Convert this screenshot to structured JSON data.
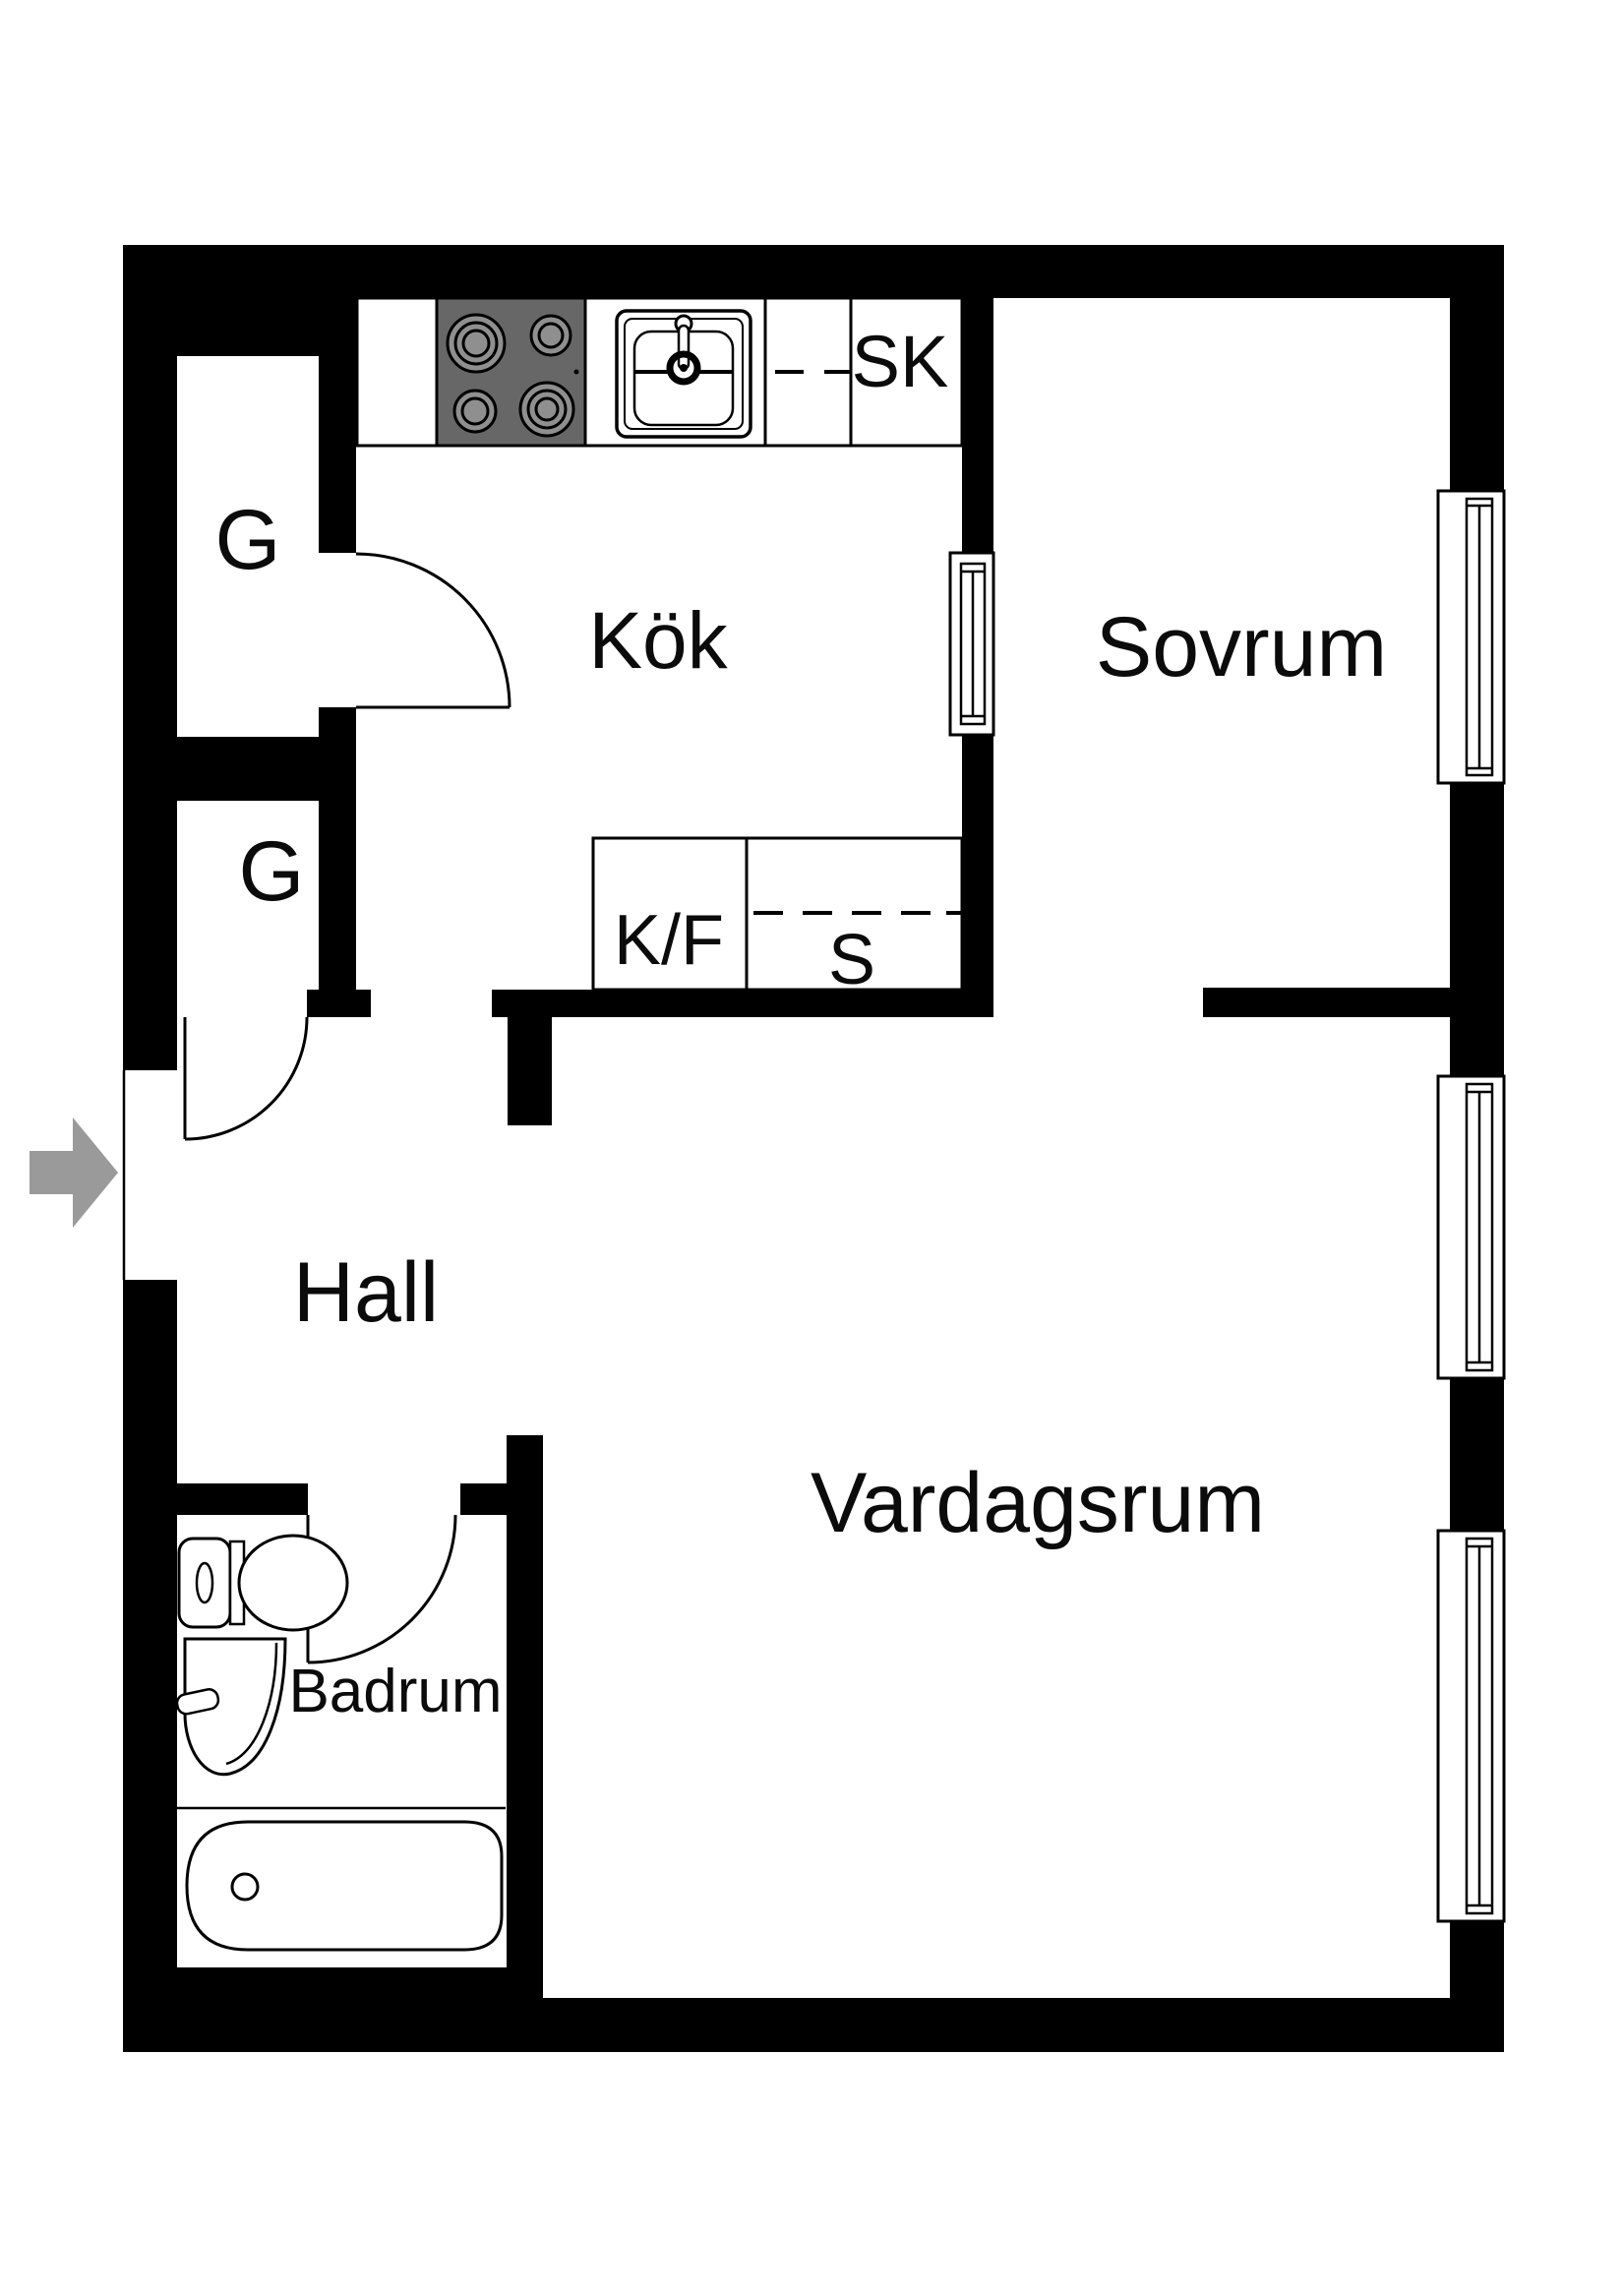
{
  "document": {
    "type": "apartment floor plan",
    "language": "Swedish"
  },
  "colors": {
    "paper": "#ffffff",
    "wall": "#000000",
    "line": "#000000",
    "stove_cell": "#676767",
    "burner": "#8f8f8f",
    "arrow": "#9a9a9a"
  },
  "labels": {
    "kitchen": "Kök",
    "bedroom": "Sovrum",
    "hall": "Hall",
    "living_room": "Vardagsrum",
    "bathroom": "Badrum",
    "closet_upper": "G",
    "closet_lower": "G",
    "cabinet_sk": "SK",
    "fridge_freezer": "K/F",
    "pantry": "S"
  },
  "fixtures": {
    "stove": "stove-icon",
    "kitchen_sink": "kitchen-sink-icon",
    "toilet": "toilet-icon",
    "washbasin": "washbasin-icon",
    "bathtub": "bathtub-icon",
    "windows": "window-icon",
    "interior_window": "interior-window-icon",
    "door_swings": "door-swing-icon",
    "entrance": "entrance-arrow-icon"
  }
}
